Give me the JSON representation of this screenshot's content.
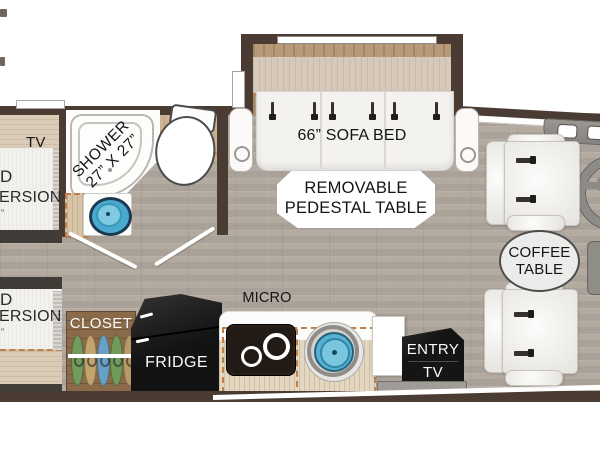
{
  "labels": {
    "sofa_bed": "66” SOFA BED",
    "pedestal_line1": "REMOVABLE",
    "pedestal_line2": "PEDESTAL TABLE",
    "shower_line1": "SHOWER",
    "shower_line2": "27” X 27”",
    "coffee_line1": "COFFEE",
    "coffee_line2": "TABLE",
    "micro": "MICRO",
    "fridge": "FRIDGE",
    "closet": "CLOSET",
    "entry": "ENTRY",
    "entry_tv": "TV",
    "bedroom_tv": "TV",
    "bed_top": {
      "frag1": "D",
      "frag2": "ERSION",
      "frag3": "”"
    },
    "bed_bottom": {
      "frag1": "D",
      "frag2": "ERSION",
      "frag3": "”"
    }
  },
  "colors": {
    "wall": "#4a3b33",
    "floor": "#b3aaa0",
    "slide_wood": "#b89a7b",
    "accent_dashed": "#c0804a",
    "sink_blue": "#57b1d2",
    "cooktop_black": "#221a14",
    "fridge_black": "#141414",
    "closet_wood": "#8a6a49",
    "seat_white": "#f4f2ef",
    "steel_gray": "#8d8b87"
  }
}
